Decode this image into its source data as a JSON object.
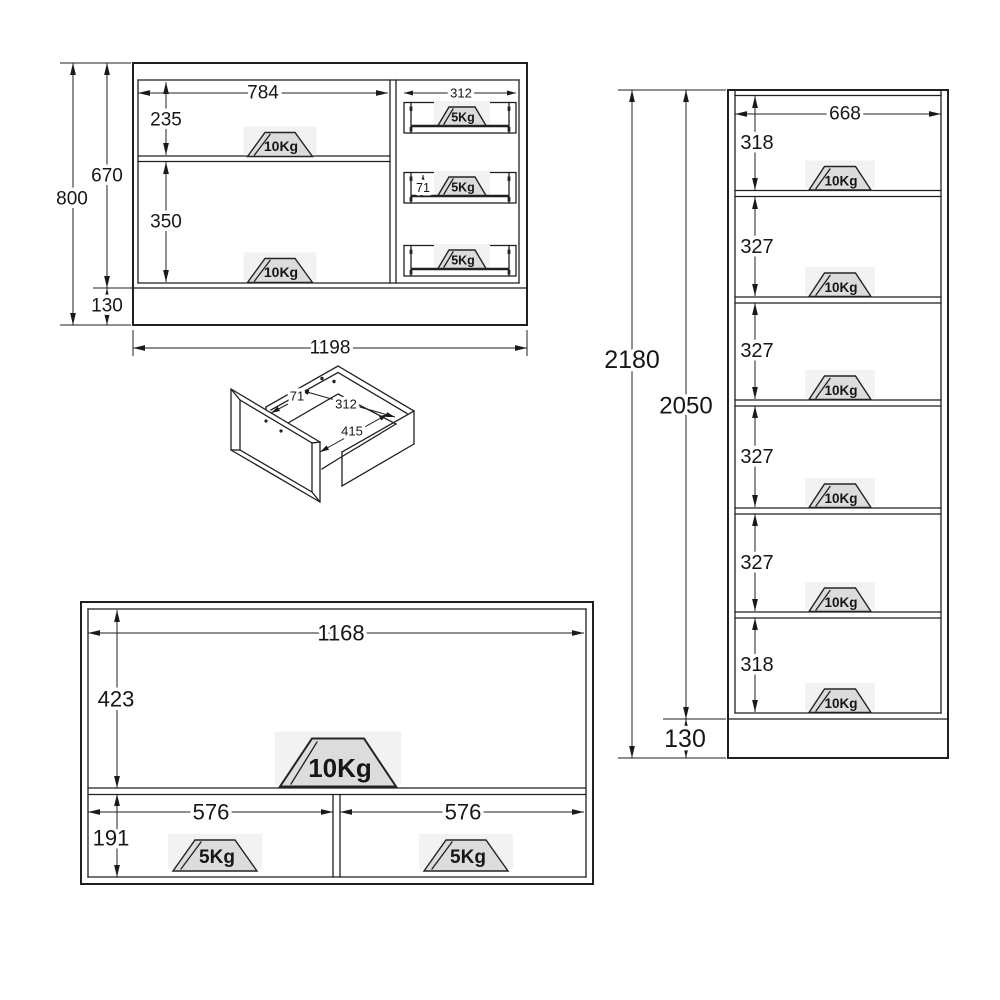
{
  "diagram": {
    "cabinet": {
      "overall_height": "800",
      "carcass_height": "670",
      "plinth_height": "130",
      "overall_width": "1198",
      "shelf_width": "784",
      "top_compartment_height": "235",
      "bottom_compartment_height": "350",
      "drawer_front_width": "312",
      "drawer_front_height": "71",
      "shelf_load": "10Kg",
      "drawer_load": "5Kg"
    },
    "drawer_3d": {
      "height": "71",
      "width": "312",
      "depth": "415"
    },
    "tall_unit": {
      "overall_height": "2180",
      "carcass_height": "2050",
      "plinth_height": "130",
      "inner_width": "668",
      "compartment_heights": [
        "318",
        "327",
        "327",
        "327",
        "327",
        "318"
      ],
      "shelf_load": "10Kg"
    },
    "low_unit": {
      "inner_width": "1168",
      "top_compartment_height": "423",
      "bottom_compartment_height": "191",
      "left_compartment_width": "576",
      "right_compartment_width": "576",
      "top_load": "10Kg",
      "bottom_load": "5Kg"
    }
  }
}
